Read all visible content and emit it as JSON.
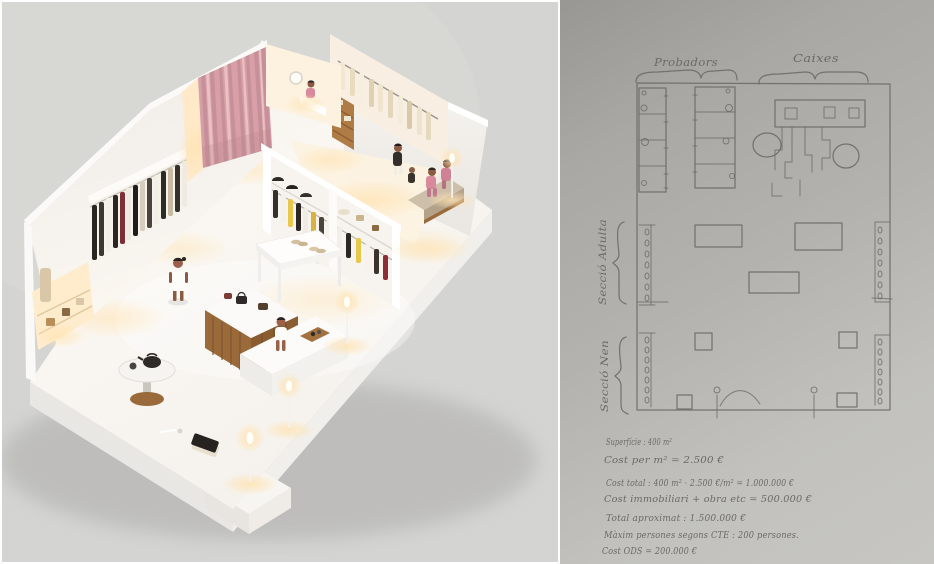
{
  "left_photo": {
    "scene": "isometric miniature clothing store model",
    "elements": [
      "white-platform-base",
      "back-wall",
      "pink-curtain",
      "lit-doorway",
      "wall-clothing-rack",
      "lit-niche-shelves",
      "fitting-nook-with-mirror",
      "inner-room",
      "cream-clothing-rack",
      "wood-shelf-unit",
      "tweed-bench",
      "seated-figures-pink",
      "front-shelving-with-hats-and-clothes",
      "white-display-table-shoes",
      "wood-island-counter-with-handbags",
      "round-side-table-kettle",
      "white-bench-seated-figure",
      "standing-figure-white-dress",
      "floor-lamps",
      "laptop-on-floor",
      "step-platform"
    ]
  },
  "right_sketch": {
    "labels": {
      "probadors": "Probadors",
      "caixes": "Caixes",
      "seccio_adulta": "Secció Adulta",
      "seccio_nen": "Secció Nen"
    },
    "notes": [
      "Superfície :  400 m²",
      "Cost per m² =  2.500 €",
      "Cost total :  400 m² · 2.500 €/m²  =  1.000.000 €",
      "Cost immobiliari + obra etc =  500.000 €",
      "Total aproximat :  1.500.000 €",
      "Màxim persones segons CTE :  200 persones.",
      "Cost ODS =  200.000 €"
    ]
  },
  "colors": {
    "photo_background": "#d4d4d2",
    "floor_white": "#f8f5f1",
    "wall_white": "#f4f1ed",
    "curtain_pink": "#d8a0a6",
    "curtain_pink_dark": "#c48e98",
    "warm_light": "#ffe3b3",
    "wood": "#9a6a3b",
    "paper_gray": "#b3b2ae",
    "pencil_gray": "#6b6a66",
    "accent_yellow": "#e8c84a",
    "accent_pink_clothing": "#d8899a"
  }
}
